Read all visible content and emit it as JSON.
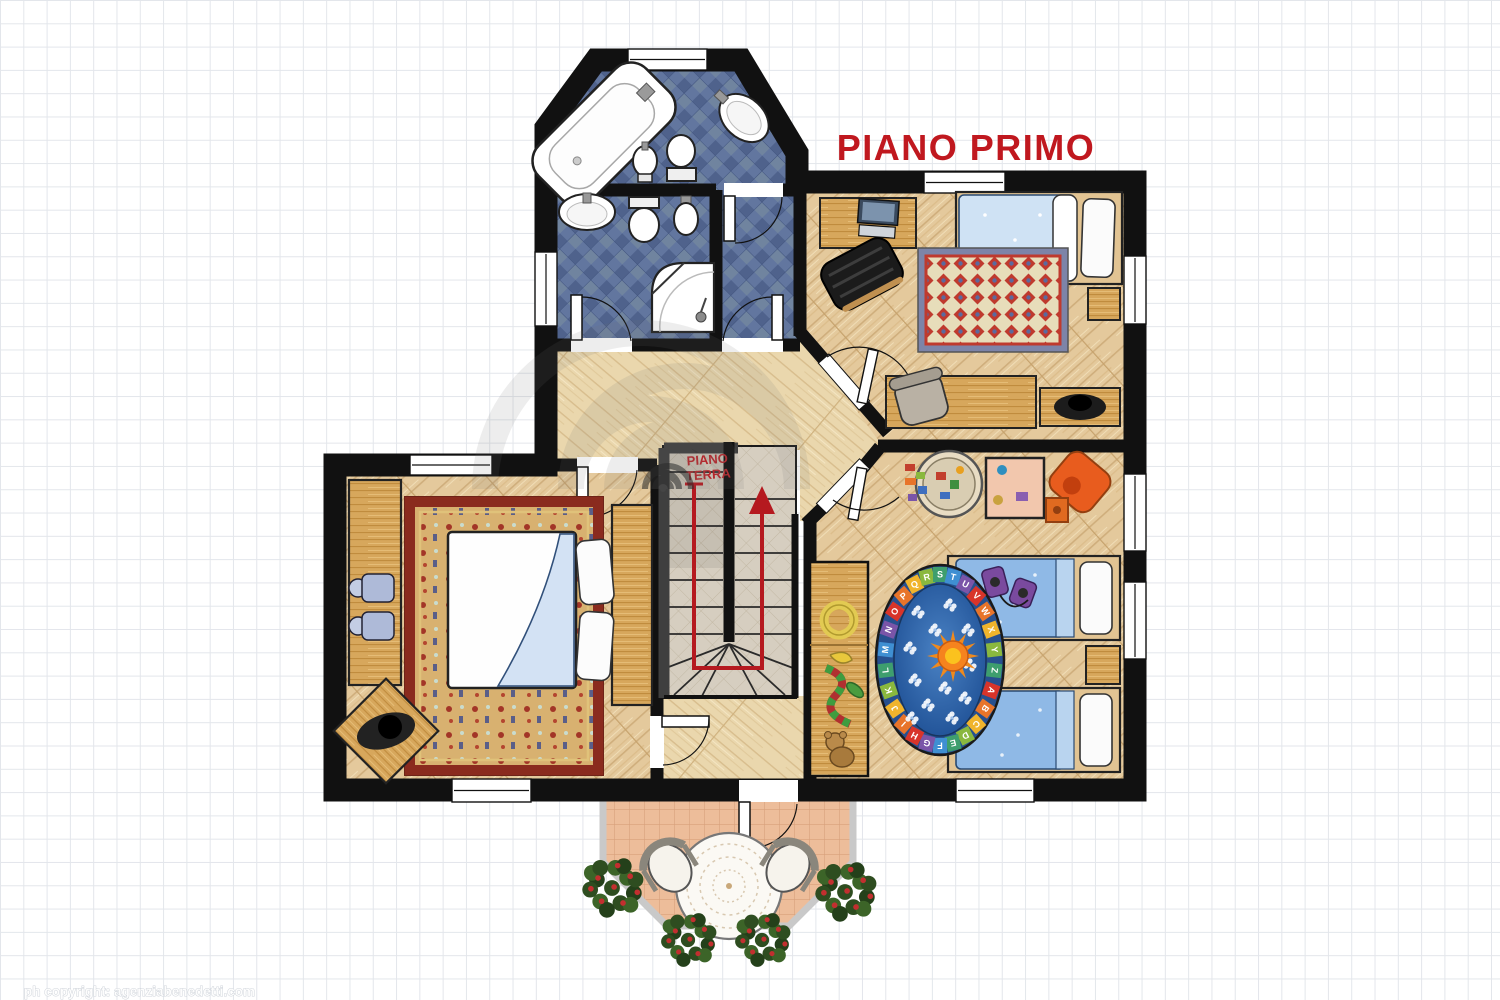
{
  "header": {
    "title": "PIANO PRIMO",
    "title_color": "#c0181f"
  },
  "staircase": {
    "label_line1": "PIANO",
    "label_line2": "TERRA",
    "label_color": "#b5272c",
    "arrow_color": "#b5191f"
  },
  "footer": {
    "copyright": "ph copyright: agenziabenedetti.com"
  },
  "kids_room": {
    "alphabet_rug_letters": "ABCDEFGHIJKLMNOPQRSTUVWXYZ",
    "rug_ring_colors": [
      "#d8342a",
      "#e8742a",
      "#f0b42c",
      "#8ab83e",
      "#3e9e6e",
      "#3f8fd2",
      "#7a55a8"
    ]
  },
  "palette": {
    "wall": "#111111",
    "stair_wall": "#3f3f3f",
    "wood_room": "#e4c99c",
    "wood_hall": "#ead7ad",
    "bath_tile": "#5f739e",
    "stair_floor": "#d6cec0",
    "terrace_floor": "#edbd9a",
    "furniture_wood": "#d7a75c",
    "kids_bed_blue": "#8fb9e6",
    "bedroom_bed_blue": "#cfe2f4",
    "grid_line": "#e3e6eb",
    "railing": "#c9c9c9"
  }
}
